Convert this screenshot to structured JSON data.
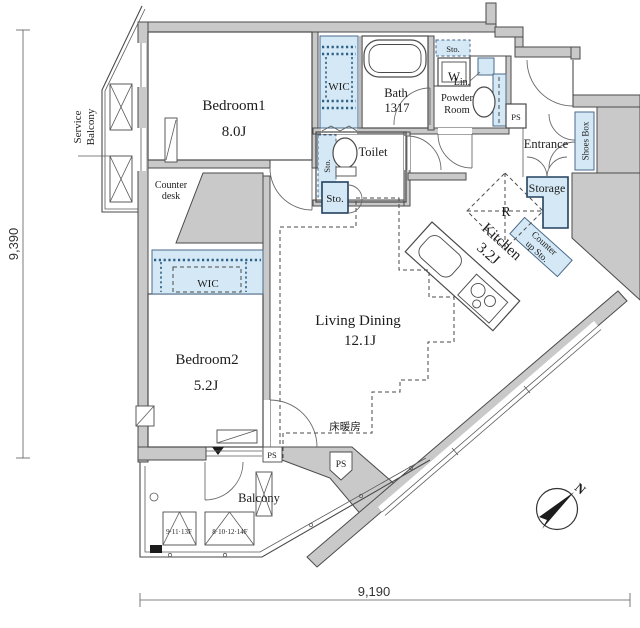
{
  "plan": {
    "rooms": {
      "bedroom1": {
        "name": "Bedroom1",
        "area": "8.0J"
      },
      "bedroom2": {
        "name": "Bedroom2",
        "area": "5.2J"
      },
      "living_dining": {
        "name": "Living Dining",
        "area": "12.1J"
      },
      "kitchen": {
        "name": "Kitchen",
        "area": "3.2J"
      },
      "bath": {
        "name": "Bath",
        "size": "1317"
      }
    },
    "labels": {
      "wic": "WIC",
      "toilet": "Toilet",
      "powder_line1": "Powder",
      "powder_line2": "Room",
      "lin": "Lin.",
      "sto": "Sto.",
      "w": "W",
      "r": "R",
      "ps": "PS",
      "entrance": "Entrance",
      "storage": "Storage",
      "shoes_box": "Shoes Box",
      "counter_up_line1": "Counter",
      "counter_up_line2": "up Sto.",
      "counter_desk_line1": "Counter",
      "counter_desk_line2": "desk",
      "service_line1": "Service",
      "service_line2": "Balcony",
      "balcony": "Balcony",
      "floor_heating": "床暖房",
      "hatch_upper": "9·11·13F",
      "hatch_lower": "8·10·12·14F",
      "north": "N"
    },
    "dimensions": {
      "vertical": "9,390",
      "horizontal": "9,190"
    },
    "colors": {
      "wall": "#c9c9c9",
      "storage_fill": "#d4e8f5",
      "line": "#4a4a4a"
    }
  }
}
